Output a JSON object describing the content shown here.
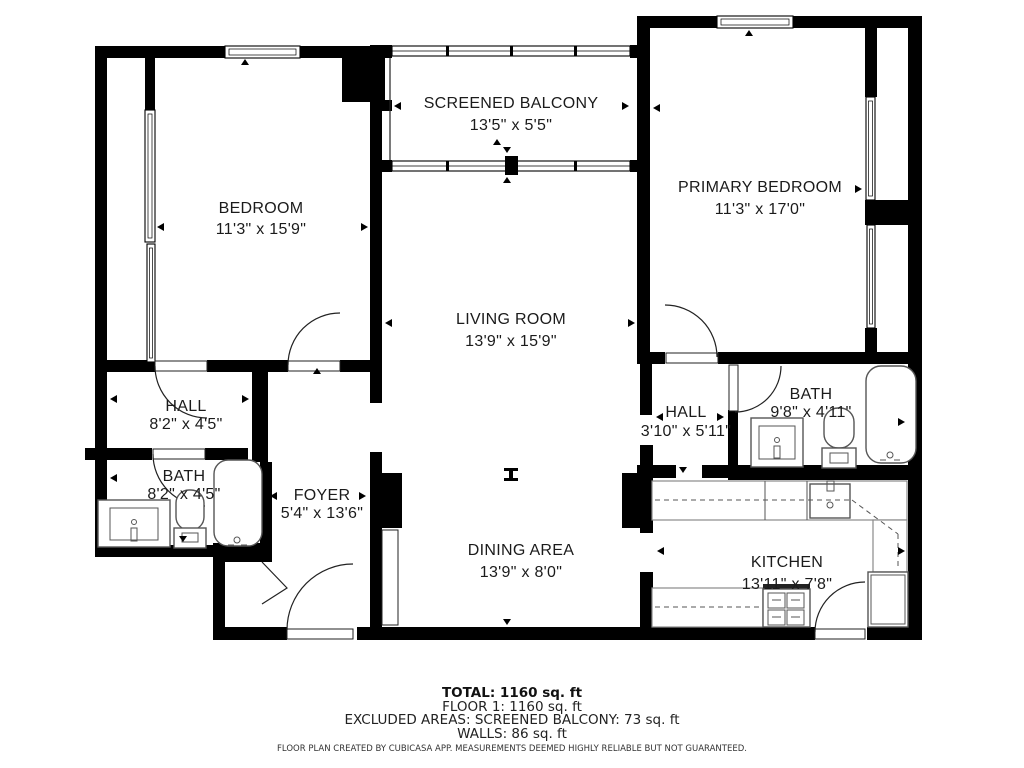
{
  "rooms": {
    "balcony": {
      "name": "SCREENED BALCONY",
      "dims": "13'5\" x 5'5\""
    },
    "bedroom": {
      "name": "BEDROOM",
      "dims": "11'3\" x 15'9\""
    },
    "primary": {
      "name": "PRIMARY BEDROOM",
      "dims": "11'3\" x 17'0\""
    },
    "living": {
      "name": "LIVING ROOM",
      "dims": "13'9\" x 15'9\""
    },
    "hall_left": {
      "name": "HALL",
      "dims": "8'2\" x 4'5\""
    },
    "bath_left": {
      "name": "BATH",
      "dims": "8'2\" x 4'5\""
    },
    "foyer": {
      "name": "FOYER",
      "dims": "5'4\" x 13'6\""
    },
    "hall_right": {
      "name": "HALL",
      "dims": "3'10\" x 5'11\""
    },
    "bath_right": {
      "name": "BATH",
      "dims": "9'8\" x 4'11\""
    },
    "dining": {
      "name": "DINING AREA",
      "dims": "13'9\" x 8'0\""
    },
    "kitchen": {
      "name": "KITCHEN",
      "dims": "13'11\" x 7'8\""
    }
  },
  "summary": {
    "total": "TOTAL: 1160 sq. ft",
    "floor": "FLOOR 1: 1160 sq. ft",
    "excluded": "EXCLUDED AREAS: SCREENED BALCONY: 73 sq. ft",
    "walls": "WALLS: 86 sq. ft"
  },
  "disclaimer": "FLOOR PLAN CREATED BY CUBICASA APP. MEASUREMENTS DEEMED HIGHLY RELIABLE BUT NOT GUARANTEED.",
  "colors": {
    "wall": "#000000",
    "fixture": "#555555",
    "counter": "#8a8a8a"
  }
}
